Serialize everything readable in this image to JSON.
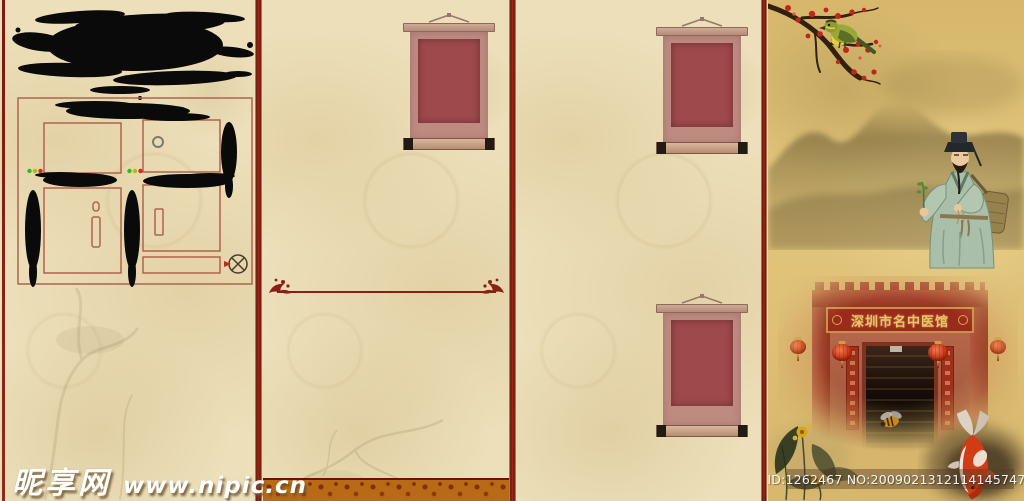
{
  "watermarks": {
    "site_name": "昵享网",
    "site_url": "www.nipic.cn",
    "image_id_line": "ID:1262467 NO:20090213121141457479"
  },
  "storefront": {
    "plaque_text": "深圳市名中医馆"
  },
  "colors": {
    "parchment": "#ecdfb9",
    "divider_red": "#9e2a16",
    "ink_black": "#0a0a0a",
    "scroll_frame": "#bd8b80",
    "scroll_panel": "#9e4a4d",
    "golden_art_panel": "#d9ba70",
    "plaque_board_red": "#992a1c",
    "plaque_gold": "#e8c668",
    "footer_band_orange": "#b96a16",
    "blossom_red": "#c2251c",
    "lantern_red": "#c33414",
    "watermark_white": "#ffffff"
  },
  "icons": {
    "registration_mark_icon": "circle with X cross and small red arrow",
    "status_dots": [
      "green",
      "yellow-green",
      "red"
    ]
  }
}
